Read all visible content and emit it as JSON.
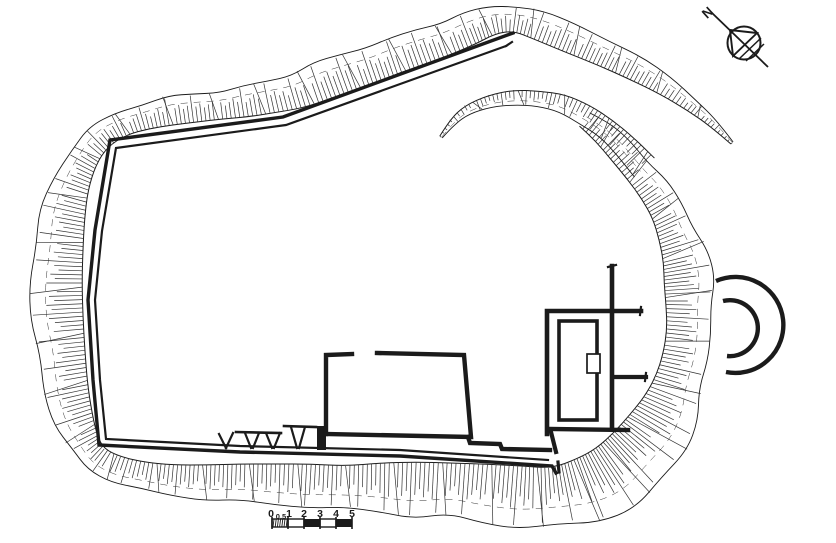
{
  "compass": {
    "label": "N"
  },
  "scale_bar": {
    "labels": [
      {
        "t": "0",
        "x": 271
      },
      {
        "t": "0.5",
        "x": 281
      },
      {
        "t": "1",
        "x": 289
      },
      {
        "t": "2",
        "x": 304
      },
      {
        "t": "3",
        "x": 320
      },
      {
        "t": "4",
        "x": 336
      },
      {
        "t": "5",
        "x": 352
      }
    ],
    "x0": 272,
    "unit": 16,
    "y_top": 519,
    "height": 8,
    "cells": [
      "hatch",
      "white",
      "black",
      "white",
      "black"
    ]
  },
  "plan": {
    "colors": {
      "ink": "#1b1b1b",
      "hachure": "#333333",
      "paper": "#ffffff"
    },
    "bands": [
      {
        "name": "outer-rampart-scarp",
        "points": [
          [
            732,
            143,
            1.5
          ],
          [
            714,
            124,
            4
          ],
          [
            692,
            105,
            7
          ],
          [
            666,
            86,
            10
          ],
          [
            636,
            69,
            12
          ],
          [
            603,
            52,
            14
          ],
          [
            568,
            37,
            15
          ],
          [
            539,
            26,
            14
          ],
          [
            515,
            18,
            13
          ],
          [
            492,
            20,
            14
          ],
          [
            470,
            29,
            16
          ],
          [
            446,
            38,
            17
          ],
          [
            421,
            47,
            18
          ],
          [
            396,
            56,
            17
          ],
          [
            371,
            64,
            19
          ],
          [
            346,
            73,
            19
          ],
          [
            321,
            82,
            19
          ],
          [
            296,
            91,
            18
          ],
          [
            271,
            97,
            16
          ],
          [
            246,
            102,
            15
          ],
          [
            221,
            105,
            14
          ],
          [
            196,
            108,
            14
          ],
          [
            171,
            111,
            14
          ],
          [
            146,
            116,
            13
          ],
          [
            121,
            124,
            12
          ],
          [
            99,
            137,
            13
          ],
          [
            83,
            157,
            15
          ],
          [
            71,
            184,
            18
          ],
          [
            63,
            214,
            22
          ],
          [
            58,
            248,
            25
          ],
          [
            56,
            283,
            26
          ],
          [
            58,
            318,
            25
          ],
          [
            61,
            353,
            24
          ],
          [
            66,
            389,
            22
          ],
          [
            74,
            419,
            19
          ],
          [
            84,
            443,
            15
          ],
          [
            96,
            459,
            13
          ],
          [
            116,
            469,
            13
          ],
          [
            142,
            476,
            14
          ],
          [
            172,
            480,
            15
          ],
          [
            206,
            482,
            17
          ],
          [
            240,
            483,
            19
          ],
          [
            275,
            484,
            20
          ],
          [
            310,
            485,
            21
          ],
          [
            345,
            488,
            22
          ],
          [
            380,
            487,
            24
          ],
          [
            415,
            489,
            27
          ],
          [
            450,
            490,
            27
          ],
          [
            485,
            493,
            29
          ],
          [
            520,
            496,
            30
          ],
          [
            555,
            498,
            30
          ],
          [
            588,
            490,
            33
          ],
          [
            615,
            477,
            34
          ],
          [
            640,
            456,
            35
          ],
          [
            658,
            432,
            33
          ],
          [
            670,
            408,
            28
          ],
          [
            679,
            383,
            24
          ],
          [
            685,
            357,
            22
          ],
          [
            688,
            331,
            21
          ],
          [
            690,
            305,
            24
          ],
          [
            689,
            281,
            25
          ],
          [
            685,
            257,
            22
          ],
          [
            677,
            233,
            19
          ],
          [
            667,
            211,
            16
          ],
          [
            654,
            190,
            15
          ],
          [
            638,
            170,
            14
          ],
          [
            620,
            150,
            13
          ],
          [
            603,
            133,
            11
          ],
          [
            585,
            119,
            9
          ]
        ]
      },
      {
        "name": "inner-scarp-arc",
        "points": [
          [
            441,
            137,
            1.5
          ],
          [
            452,
            122,
            3
          ],
          [
            467,
            110,
            5
          ],
          [
            490,
            101,
            6
          ],
          [
            514,
            97,
            7
          ],
          [
            538,
            99,
            8
          ],
          [
            562,
            103,
            9
          ],
          [
            585,
            114,
            10
          ],
          [
            606,
            129,
            11
          ],
          [
            626,
            147,
            12
          ],
          [
            645,
            167,
            13
          ]
        ]
      }
    ],
    "enclosure": {
      "outer": {
        "pts": [
          [
            513,
            33
          ],
          [
            283,
            117
          ],
          [
            110,
            140
          ],
          [
            95,
            230
          ],
          [
            88,
            300
          ],
          [
            93,
            380
          ],
          [
            99,
            445
          ],
          [
            240,
            452
          ],
          [
            400,
            456
          ],
          [
            552,
            466
          ],
          [
            556,
            473
          ]
        ],
        "w": 3.4
      },
      "inner": {
        "pts": [
          [
            506,
            46
          ],
          [
            286,
            125
          ],
          [
            116,
            148
          ],
          [
            102,
            231
          ],
          [
            95,
            300
          ],
          [
            100,
            380
          ],
          [
            106,
            439
          ],
          [
            240,
            446
          ],
          [
            400,
            450
          ],
          [
            548,
            460
          ]
        ],
        "w": 2.2
      },
      "apex_tick": {
        "pts": [
          [
            506,
            46
          ],
          [
            512,
            42
          ]
        ],
        "w": 2.2
      }
    },
    "building_walls": [
      {
        "pts": [
          [
            326,
            434
          ],
          [
            326,
            355
          ],
          [
            352,
            354
          ]
        ],
        "w": 4.4
      },
      {
        "pts": [
          [
            377,
            353
          ],
          [
            464,
            355
          ],
          [
            471,
            437
          ],
          [
            326,
            434
          ]
        ],
        "w": 4.4
      },
      {
        "pts": [
          [
            468,
            437
          ],
          [
            470,
            443
          ],
          [
            500,
            444
          ],
          [
            502,
            449
          ],
          [
            550,
            450
          ]
        ],
        "w": 4.4
      },
      {
        "pts": [
          [
            547,
            434
          ],
          [
            547,
            311
          ],
          [
            641,
            311
          ]
        ],
        "w": 4.6
      },
      {
        "pts": [
          [
            641,
            307
          ],
          [
            640,
            315
          ]
        ],
        "w": 2.2
      },
      {
        "pts": [
          [
            612,
            266
          ],
          [
            612,
            429
          ]
        ],
        "w": 4.6
      },
      {
        "pts": [
          [
            608,
            267
          ],
          [
            616,
            265
          ]
        ],
        "w": 2.2
      },
      {
        "pts": [
          [
            613,
            377
          ],
          [
            646,
            377
          ]
        ],
        "w": 4.2
      },
      {
        "pts": [
          [
            646,
            373
          ],
          [
            645,
            381
          ]
        ],
        "w": 2.2
      },
      {
        "pts": [
          [
            549,
            429
          ],
          [
            628,
            430
          ]
        ],
        "w": 4.4
      },
      {
        "pts": [
          [
            551,
            432
          ],
          [
            556,
            452
          ]
        ],
        "w": 4.2
      },
      {
        "pts": [
          [
            558,
            462
          ],
          [
            559,
            472
          ]
        ],
        "w": 3.2
      }
    ],
    "inner_room": {
      "x": 559,
      "y": 321,
      "w": 38,
      "h": 99,
      "stroke": 3.6
    },
    "door": {
      "x": 587,
      "y": 354,
      "w": 13,
      "h": 19,
      "stroke": 1.7
    },
    "gate_lines": [
      {
        "pts": [
          [
            219,
            434
          ],
          [
            226,
            448
          ]
        ],
        "w": 2.2
      },
      {
        "pts": [
          [
            233,
            433
          ],
          [
            226,
            448
          ]
        ],
        "w": 2.2
      },
      {
        "pts": [
          [
            236,
            432
          ],
          [
            281,
            433
          ]
        ],
        "w": 2.6
      },
      {
        "pts": [
          [
            245,
            433
          ],
          [
            251,
            448
          ]
        ],
        "w": 2.2
      },
      {
        "pts": [
          [
            259,
            433
          ],
          [
            253,
            448
          ]
        ],
        "w": 2.2
      },
      {
        "pts": [
          [
            266,
            433
          ],
          [
            272,
            448
          ]
        ],
        "w": 2.2
      },
      {
        "pts": [
          [
            280,
            433
          ],
          [
            274,
            448
          ]
        ],
        "w": 2.2
      },
      {
        "pts": [
          [
            284,
            426
          ],
          [
            316,
            427
          ]
        ],
        "w": 2.6
      },
      {
        "pts": [
          [
            291,
            427
          ],
          [
            297,
            448
          ]
        ],
        "w": 2.2
      },
      {
        "pts": [
          [
            305,
            427
          ],
          [
            299,
            448
          ]
        ],
        "w": 2.2
      }
    ],
    "gate_block": {
      "x": 317,
      "y": 426,
      "w": 9,
      "h": 24
    },
    "tower": {
      "outer": "M 716 281 A 48 48 0 1 1 726 372",
      "inner": "M 723 301 A 28 28 0 1 1 727 356",
      "stroke": 4.4
    },
    "north_arrow": {
      "cx": 744,
      "cy": 43,
      "r": 16.5,
      "line": [
        [
          711,
          12
        ],
        [
          768,
          67
        ]
      ],
      "triangle": "M 730 30 L 757 33 L 733 56 Z",
      "hatches": [
        [
          [
            761,
            38
          ],
          [
            739,
            59
          ]
        ],
        [
          [
            764,
            44
          ],
          [
            746,
            61
          ]
        ]
      ]
    }
  }
}
